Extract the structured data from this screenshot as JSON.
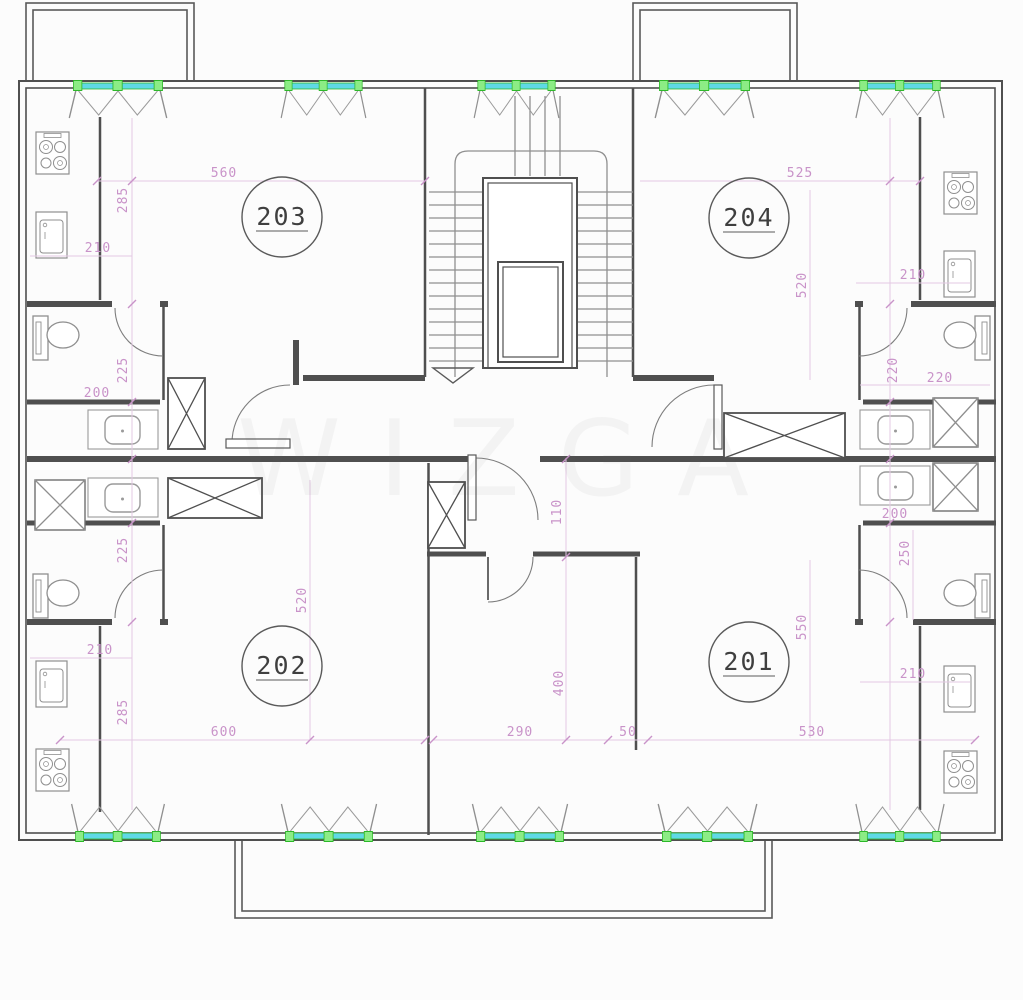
{
  "rooms": [
    {
      "number": "203"
    },
    {
      "number": "204"
    },
    {
      "number": "202"
    },
    {
      "number": "201"
    }
  ],
  "dims": [
    {
      "v": "560"
    },
    {
      "v": "285"
    },
    {
      "v": "210"
    },
    {
      "v": "225"
    },
    {
      "v": "200"
    },
    {
      "v": "525"
    },
    {
      "v": "520"
    },
    {
      "v": "210"
    },
    {
      "v": "220"
    },
    {
      "v": "220"
    },
    {
      "v": "225"
    },
    {
      "v": "210"
    },
    {
      "v": "285"
    },
    {
      "v": "600"
    },
    {
      "v": "520"
    },
    {
      "v": "200"
    },
    {
      "v": "250"
    },
    {
      "v": "550"
    },
    {
      "v": "530"
    },
    {
      "v": "210"
    },
    {
      "v": "50"
    },
    {
      "v": "110"
    },
    {
      "v": "400"
    },
    {
      "v": "290"
    }
  ],
  "watermark": {
    "text": "WIZGA"
  },
  "colors": {
    "wall": "#4f4f4f",
    "fixture": "#8f8f8f",
    "dimension_text": "#c993c9",
    "dimension_line": "#e3c9e3",
    "window_glass": "#5fd9e6",
    "window_frame": "#46d63e",
    "background": "#fcfcfc"
  }
}
